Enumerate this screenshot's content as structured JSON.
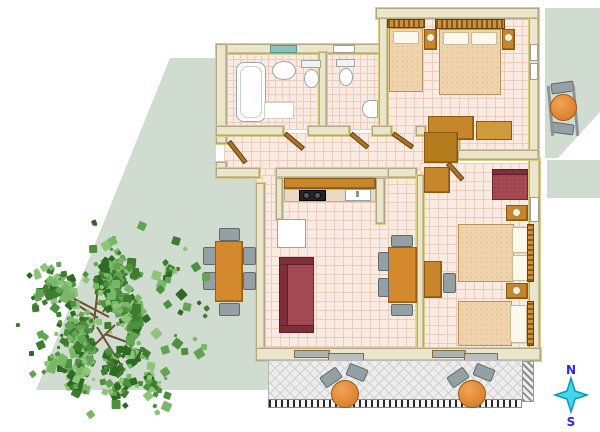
{
  "meta": {
    "kind": "apartment-floor-plan-top-view"
  },
  "compass": {
    "north": "N",
    "south": "S"
  },
  "palette": {
    "floor_tile": "#f9ebe2",
    "tile_grout": "#ecccbd",
    "wall": "#ebe5c9",
    "wall_trim_yellow": "#d8ca74",
    "wood": "#c8862c",
    "table_orange": "#d4892c",
    "bed_linen": "#eed3ad",
    "pillow": "#fcf8ec",
    "sofa_red": "#a34a54",
    "chair_gray": "#95a0a4",
    "window_teal": "#8cc2c2",
    "garden_green": "#cfdccf",
    "balcony_tile": "#ededed",
    "compass_star": "#45d6ea",
    "compass_letters": "#2a2ae0"
  },
  "rooms": [
    {
      "id": "bathroom",
      "furniture": [
        "bathtub",
        "washbasin",
        "toilet",
        "bath-mat",
        "teal-window"
      ]
    },
    {
      "id": "wc",
      "furniture": [
        "toilet",
        "corner-washbasin",
        "window"
      ]
    },
    {
      "id": "bedroom-north",
      "furniture": [
        "single-bed",
        "double-bed",
        "nightstand-with-lamp-left",
        "nightstand-with-lamp-right",
        "low-cabinet",
        "side-cabinet",
        "right-wall-window"
      ]
    },
    {
      "id": "hallway",
      "furniture": [
        "entrance-door",
        "wardrobe"
      ]
    },
    {
      "id": "living-room-kitchen",
      "furniture": [
        "kitchen-counter",
        "stove",
        "kitchen-sink",
        "fridge",
        "red-sofa",
        "dining-table",
        "four-gray-chairs",
        "sliding-glass-door"
      ]
    },
    {
      "id": "bedroom-south",
      "furniture": [
        "red-armchair",
        "double-bed",
        "single-bed",
        "two-nightstands-with-lamps",
        "desk",
        "desk-chair",
        "wardrobe-nook",
        "sliding-glass-door"
      ]
    },
    {
      "id": "balcony-south",
      "furniture": [
        "round-table-west",
        "round-table-east",
        "four-gray-chairs"
      ]
    },
    {
      "id": "balcony-east",
      "furniture": [
        "round-table",
        "two-gray-chairs"
      ]
    },
    {
      "id": "garden-west",
      "furniture": [
        "rectangular-table",
        "six-gray-chairs",
        "large-tree"
      ]
    }
  ],
  "tree": {
    "seed": 11,
    "clusters": 30,
    "cluster_leaves_min": 12,
    "cluster_leaves_max": 22,
    "scatter": 85,
    "leaf_colors": [
      "#3f7c2f",
      "#4f9040",
      "#63a452",
      "#79b868",
      "#8cc47a",
      "#2f6a24"
    ],
    "twig_color": "#6d4f2e"
  }
}
